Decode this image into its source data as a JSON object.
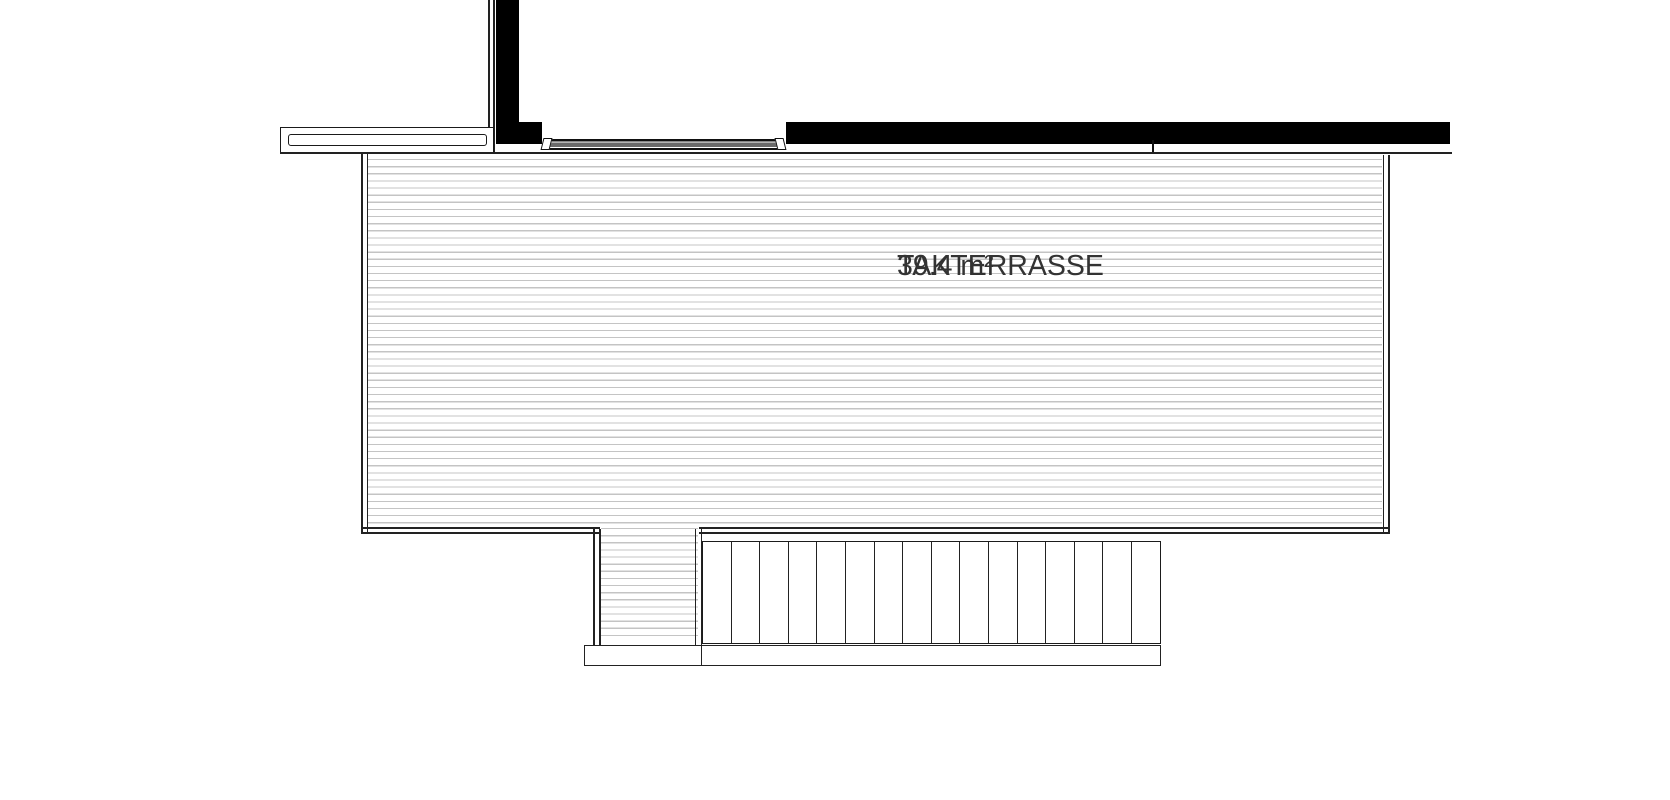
{
  "plan": {
    "room_label": "TAKTERRASSE",
    "room_area": "39.4 m²",
    "stair_tread_count": 16
  },
  "colors": {
    "background": "#ffffff",
    "wall_fill": "#000000",
    "line": "#222222",
    "hatch_line": "#c4c4c4",
    "door_track_fill": "#6a6a6a",
    "label_text": "#333333"
  }
}
